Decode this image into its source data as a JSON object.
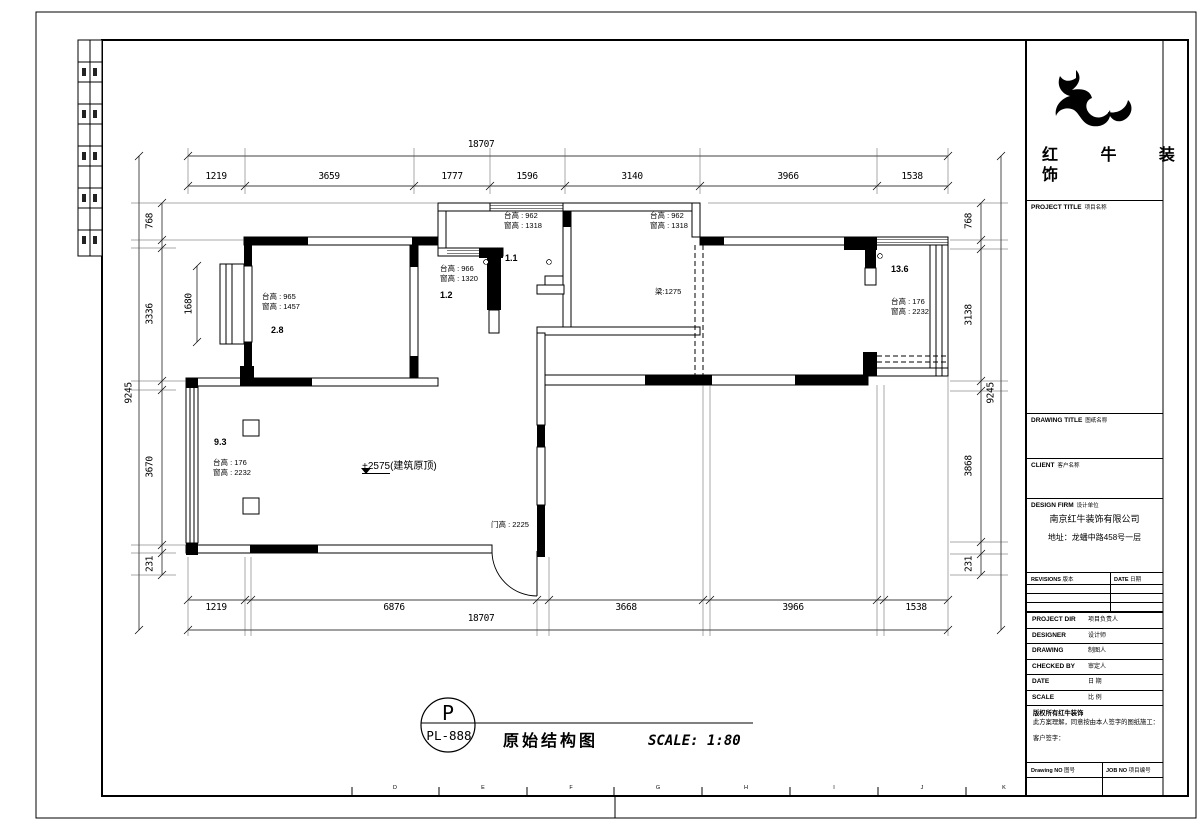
{
  "sheet": {
    "grid_letters": [
      "D",
      "E",
      "F",
      "G",
      "H",
      "I",
      "J",
      "K"
    ]
  },
  "dims": {
    "top": {
      "overall": "18707",
      "segments": [
        "1219",
        "3659",
        "1777",
        "1596",
        "3140",
        "3966",
        "1538"
      ]
    },
    "bottom": {
      "overall": "18707",
      "segments": [
        "1219",
        "6876",
        "3668",
        "3966",
        "1538"
      ]
    },
    "left": {
      "overall": "9245",
      "inner": "1680",
      "segments": [
        "768",
        "3336",
        "3670",
        "231"
      ]
    },
    "right": {
      "overall": "9245",
      "segments": [
        "768",
        "3138",
        "3868",
        "231"
      ]
    }
  },
  "plan": {
    "windows": {
      "a": {
        "l1": "台高 : 962",
        "l2": "窗高 : 1318"
      },
      "b": {
        "l1": "台高 : 962",
        "l2": "窗高 : 1318"
      },
      "c": {
        "l1": "台高 : 966",
        "l2": "窗高 : 1320"
      },
      "d": {
        "l1": "台高 : 965",
        "l2": "窗高 : 1457"
      },
      "e": {
        "l1": "台高 : 176",
        "l2": "窗高 : 2232"
      },
      "f": {
        "l1": "台高 : 176",
        "l2": "窗高 : 2232"
      }
    },
    "rooms": {
      "a": "1.1",
      "b": "1.2",
      "c": "2.8",
      "d": "9.3",
      "e": "13.6"
    },
    "beam": "梁:1275",
    "door_height": "门高 : 2225",
    "level": "+2575",
    "level_note": "(建筑原顶)"
  },
  "footer": {
    "stamp_letter": "P",
    "stamp_code": "PL-888",
    "title": "原始结构图",
    "scale": "SCALE: 1:80"
  },
  "title_block": {
    "brand_l1": "红 牛 装",
    "brand_l2": "饰",
    "sections": {
      "project": {
        "en": "PROJECT TITLE",
        "cn": "项目名称"
      },
      "drawing": {
        "en": "DRAWING TITLE",
        "cn": "图纸名称"
      },
      "client": {
        "en": "CLIENT",
        "cn": "客户名称"
      },
      "firm": {
        "en": "DESIGN FIRM",
        "cn": "设计单位"
      }
    },
    "firm_name": "南京红牛装饰有限公司",
    "firm_address": "地址：龙蟠中路458号一层",
    "revisions": {
      "en": "REVISIONS",
      "cn": "版本"
    },
    "date_col": {
      "en": "DATE",
      "cn": "日期"
    },
    "rows": [
      {
        "en": "PROJECT DIR",
        "cn": "项目负责人"
      },
      {
        "en": "DESIGNER",
        "cn": "设计师"
      },
      {
        "en": "DRAWING",
        "cn": "制图人"
      },
      {
        "en": "CHECKED BY",
        "cn": "审定人"
      },
      {
        "en": "DATE",
        "cn": "日 期"
      },
      {
        "en": "SCALE",
        "cn": "比 例"
      }
    ],
    "note1": "版权所有红牛装饰",
    "note2": "此方案理解，同意按由本人签字的图纸施工：",
    "note3": "客户签字：",
    "drawing_no": {
      "en": "Drawing NO",
      "cn": "图号"
    },
    "job_no": {
      "en": "JOB NO",
      "cn": "项目编号"
    }
  }
}
